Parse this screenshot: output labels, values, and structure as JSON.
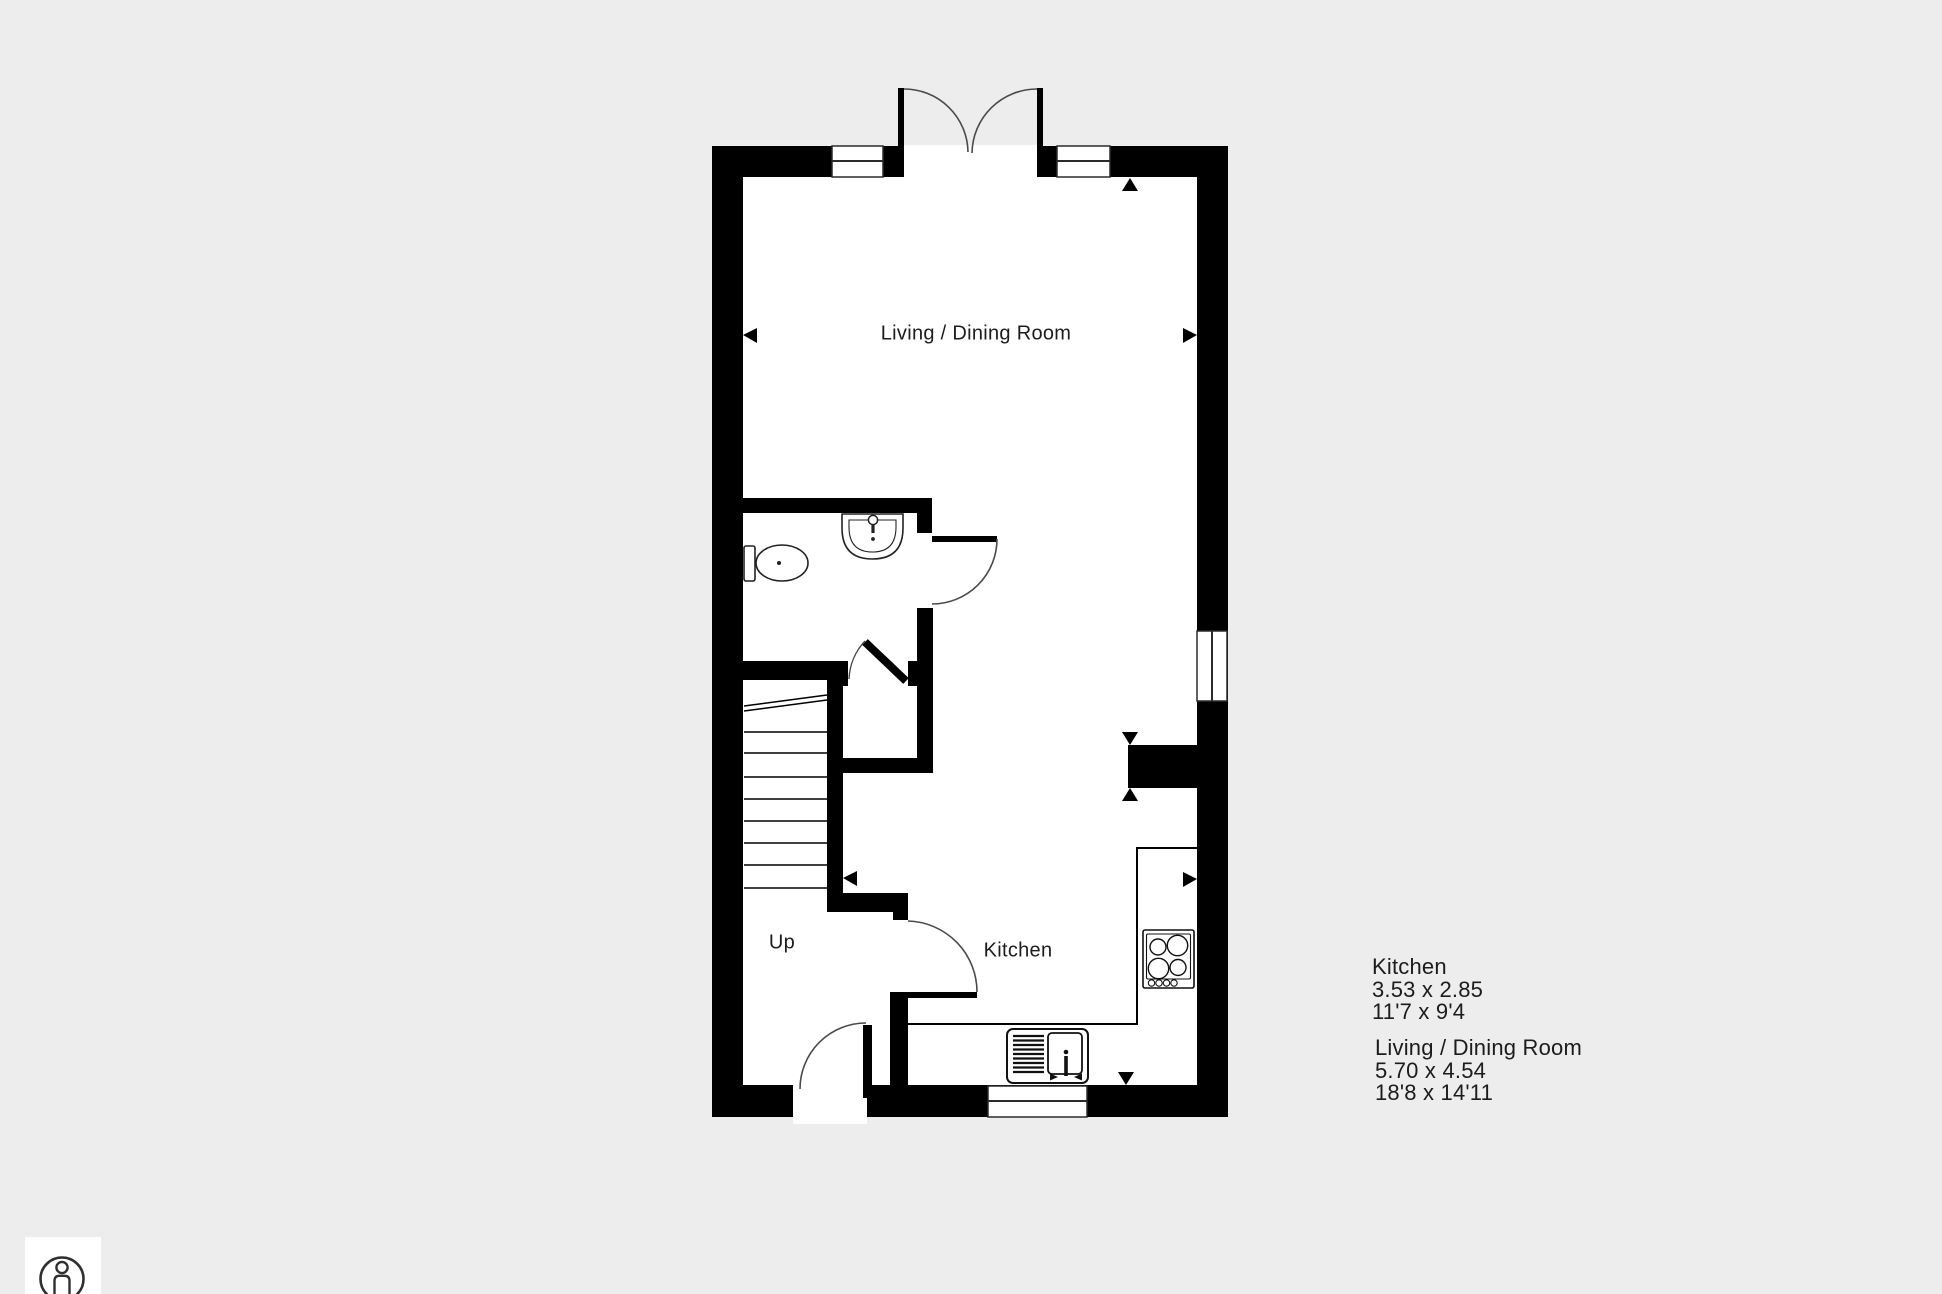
{
  "colors": {
    "background": "#ededed",
    "wall": "#000000",
    "floor": "#ffffff",
    "line": "#444444",
    "text": "#1c1c1c"
  },
  "plan": {
    "living_label": "Living / Dining Room",
    "kitchen_label": "Kitchen",
    "stairs_label": "Up"
  },
  "legend": {
    "kitchen": {
      "name": "Kitchen",
      "metric": "3.53 x 2.85",
      "imperial": "11'7 x 9'4"
    },
    "living": {
      "name": "Living / Dining Room",
      "metric": "5.70 x 4.54",
      "imperial": "18'8 x 14'11"
    }
  },
  "icons": {
    "logo": "person-in-circle"
  }
}
